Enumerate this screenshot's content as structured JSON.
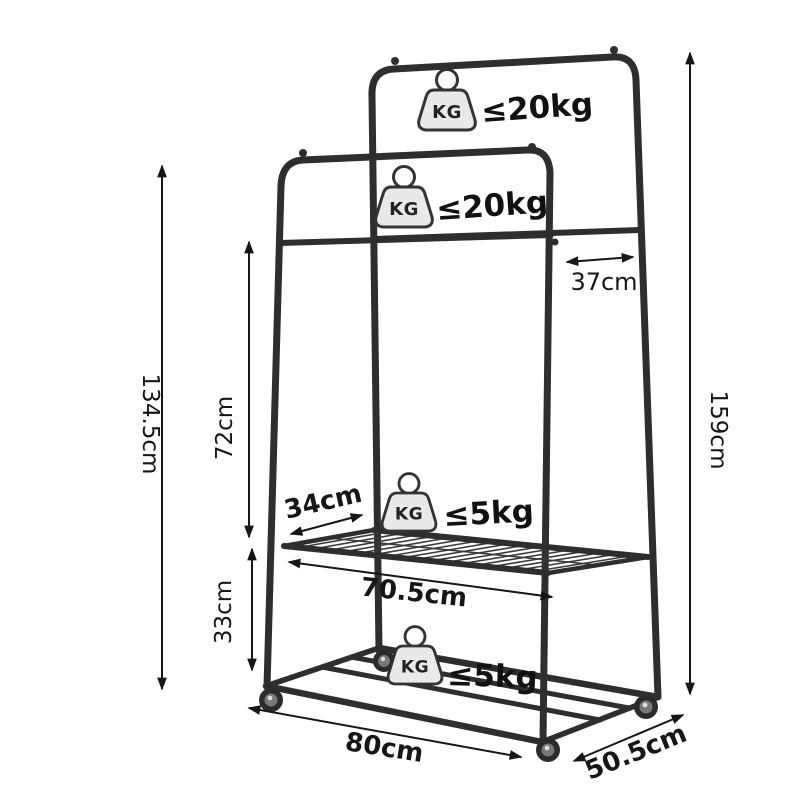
{
  "diagram": {
    "kg_icon_label": "KG",
    "weights": {
      "tall_rail": "≤20kg",
      "short_rail": "≤20kg",
      "middle_shelf": "≤5kg",
      "bottom_shelf": "≤5kg"
    },
    "dimensions": {
      "short_rack_height": "134.5cm",
      "overall_height": "159cm",
      "rail_to_shelf_height": "72cm",
      "shelf_to_floor_height": "33cm",
      "rail_gap_depth": "37cm",
      "shelf_depth": "34cm",
      "shelf_length": "70.5cm",
      "base_length": "80cm",
      "base_depth": "50.5cm"
    },
    "colors": {
      "frame": "#2e2e2e",
      "dimension_lines": "#161616",
      "icon_fill": "#e9e9e9",
      "background": "#ffffff"
    }
  }
}
